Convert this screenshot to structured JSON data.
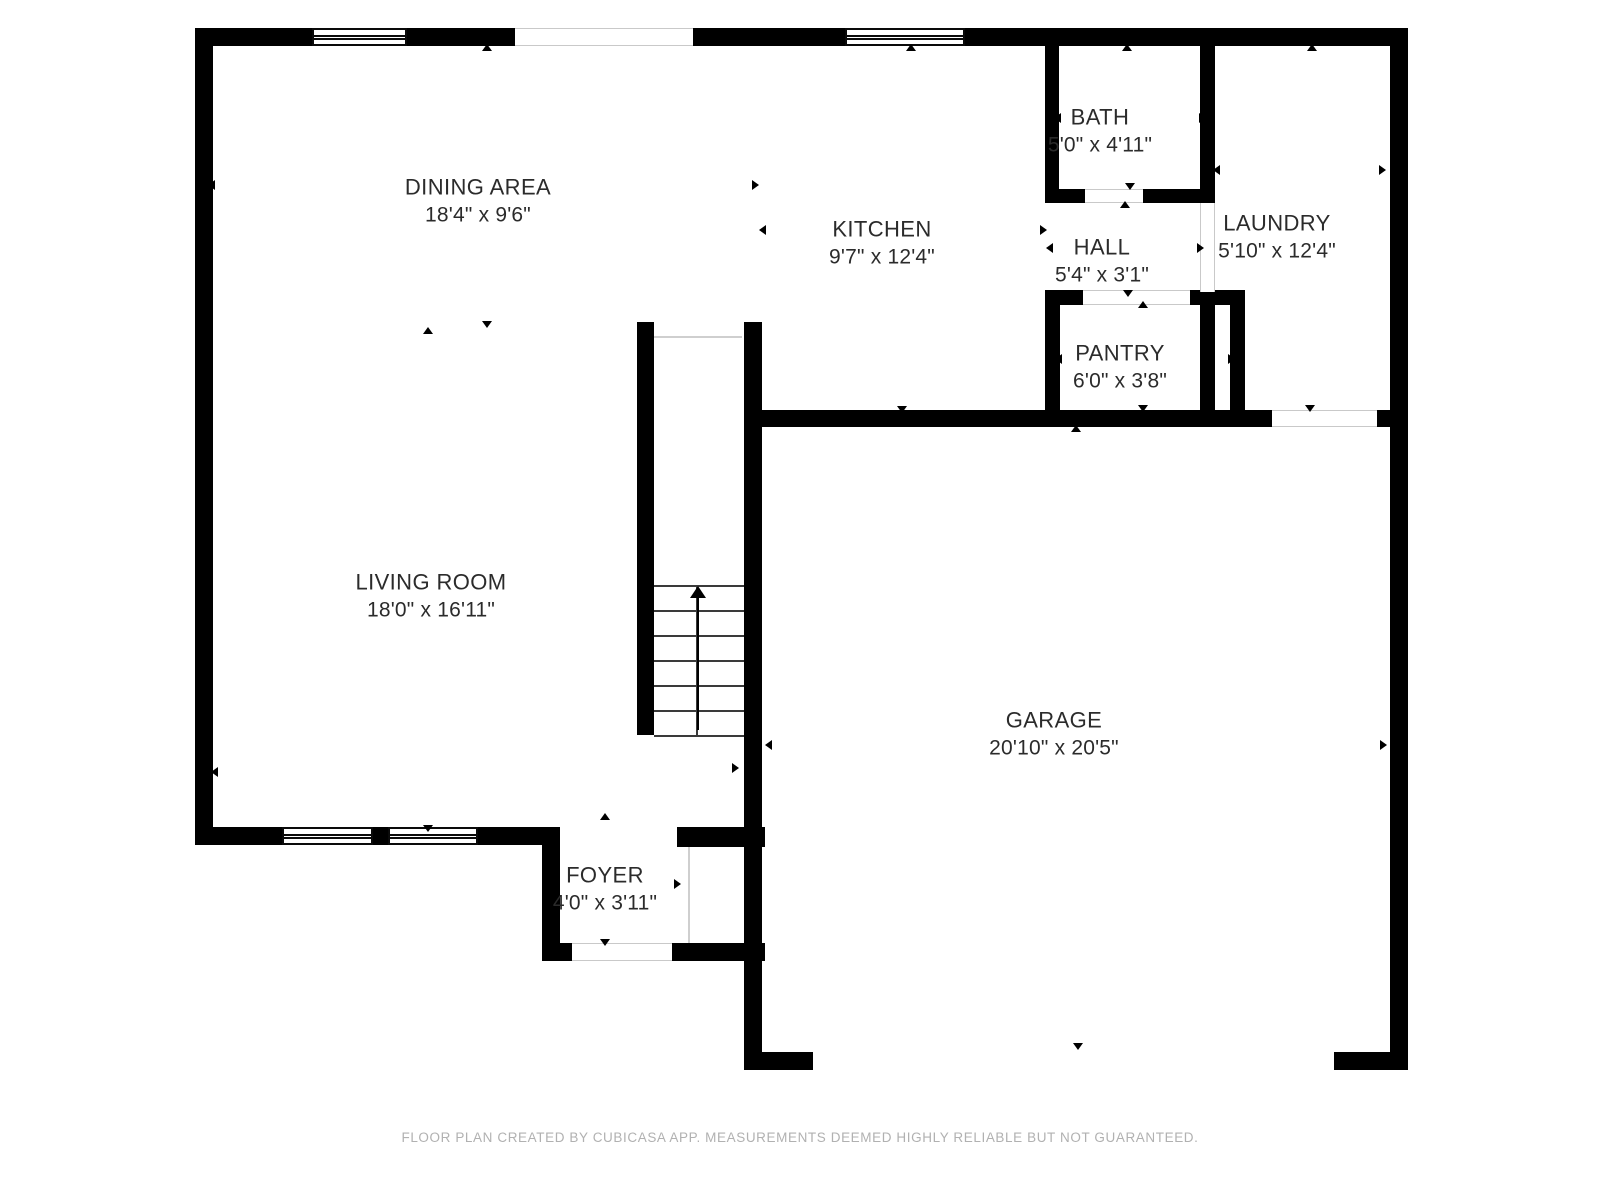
{
  "footer": {
    "text": "FLOOR PLAN CREATED BY CUBICASA APP. MEASUREMENTS DEEMED HIGHLY RELIABLE BUT NOT GUARANTEED.",
    "y": 1130
  },
  "colors": {
    "wall": "#000000",
    "background": "#ffffff",
    "label_text": "#2b2b2b",
    "footer_text": "#b1b1b1",
    "opening_line": "#c9c9c9"
  },
  "rooms": [
    {
      "id": "dining-area",
      "name": "DINING AREA",
      "dims": "18'4\" x 9'6\"",
      "cx": 478,
      "cy": 201
    },
    {
      "id": "kitchen",
      "name": "KITCHEN",
      "dims": "9'7\" x 12'4\"",
      "cx": 882,
      "cy": 243
    },
    {
      "id": "bath",
      "name": "BATH",
      "dims": "5'0\" x 4'11\"",
      "cx": 1100,
      "cy": 131
    },
    {
      "id": "hall",
      "name": "HALL",
      "dims": "5'4\" x 3'1\"",
      "cx": 1102,
      "cy": 261
    },
    {
      "id": "laundry",
      "name": "LAUNDRY",
      "dims": "5'10\" x 12'4\"",
      "cx": 1277,
      "cy": 237
    },
    {
      "id": "pantry",
      "name": "PANTRY",
      "dims": "6'0\" x 3'8\"",
      "cx": 1120,
      "cy": 367
    },
    {
      "id": "living-room",
      "name": "LIVING ROOM",
      "dims": "18'0\" x 16'11\"",
      "cx": 431,
      "cy": 596
    },
    {
      "id": "garage",
      "name": "GARAGE",
      "dims": "20'10\" x 20'5\"",
      "cx": 1054,
      "cy": 734
    },
    {
      "id": "foyer",
      "name": "FOYER",
      "dims": "4'0\" x 3'11\"",
      "cx": 605,
      "cy": 889
    }
  ],
  "walls": [
    {
      "x": 195,
      "y": 28,
      "w": 117,
      "h": 18
    },
    {
      "x": 407,
      "y": 28,
      "w": 108,
      "h": 18
    },
    {
      "x": 693,
      "y": 28,
      "w": 152,
      "h": 18
    },
    {
      "x": 965,
      "y": 28,
      "w": 443,
      "h": 18
    },
    {
      "x": 195,
      "y": 28,
      "w": 18,
      "h": 817
    },
    {
      "x": 195,
      "y": 827,
      "w": 87,
      "h": 18
    },
    {
      "x": 373,
      "y": 827,
      "w": 15,
      "h": 18
    },
    {
      "x": 478,
      "y": 827,
      "w": 82,
      "h": 18
    },
    {
      "x": 542,
      "y": 827,
      "w": 18,
      "h": 134
    },
    {
      "x": 542,
      "y": 943,
      "w": 30,
      "h": 18
    },
    {
      "x": 672,
      "y": 943,
      "w": 93,
      "h": 18
    },
    {
      "x": 677,
      "y": 827,
      "w": 88,
      "h": 20
    },
    {
      "x": 744,
      "y": 322,
      "w": 18,
      "h": 748
    },
    {
      "x": 762,
      "y": 1052,
      "w": 51,
      "h": 18
    },
    {
      "x": 637,
      "y": 322,
      "w": 17,
      "h": 413
    },
    {
      "x": 762,
      "y": 410,
      "w": 510,
      "h": 17
    },
    {
      "x": 1377,
      "y": 410,
      "w": 14,
      "h": 17
    },
    {
      "x": 1045,
      "y": 46,
      "w": 14,
      "h": 157
    },
    {
      "x": 1045,
      "y": 189,
      "w": 40,
      "h": 14
    },
    {
      "x": 1143,
      "y": 189,
      "w": 72,
      "h": 14
    },
    {
      "x": 1200,
      "y": 46,
      "w": 15,
      "h": 157
    },
    {
      "x": 1200,
      "y": 292,
      "w": 15,
      "h": 118
    },
    {
      "x": 1045,
      "y": 290,
      "w": 38,
      "h": 15
    },
    {
      "x": 1190,
      "y": 290,
      "w": 55,
      "h": 15
    },
    {
      "x": 1045,
      "y": 290,
      "w": 15,
      "h": 137
    },
    {
      "x": 1230,
      "y": 290,
      "w": 15,
      "h": 137
    },
    {
      "x": 1390,
      "y": 28,
      "w": 18,
      "h": 397
    },
    {
      "x": 1390,
      "y": 410,
      "w": 18,
      "h": 660
    },
    {
      "x": 1334,
      "y": 1052,
      "w": 74,
      "h": 18
    }
  ],
  "windows": [
    {
      "x": 312,
      "y": 28,
      "w": 95,
      "h": 18
    },
    {
      "x": 845,
      "y": 28,
      "w": 120,
      "h": 18
    },
    {
      "x": 282,
      "y": 827,
      "w": 91,
      "h": 18
    },
    {
      "x": 388,
      "y": 827,
      "w": 90,
      "h": 18
    }
  ],
  "openings": [
    {
      "x": 515,
      "y": 28,
      "w": 178,
      "h": 18,
      "o": "h"
    },
    {
      "x": 1272,
      "y": 410,
      "w": 105,
      "h": 17,
      "o": "h"
    },
    {
      "x": 572,
      "y": 943,
      "w": 100,
      "h": 18,
      "o": "h"
    },
    {
      "x": 1085,
      "y": 189,
      "w": 58,
      "h": 14,
      "o": "h"
    },
    {
      "x": 1083,
      "y": 290,
      "w": 107,
      "h": 15,
      "o": "h"
    },
    {
      "x": 1200,
      "y": 203,
      "w": 15,
      "h": 89,
      "o": "v"
    }
  ],
  "thin_lines": [
    {
      "x": 654,
      "y": 336,
      "w": 88,
      "h": 2
    },
    {
      "x": 688,
      "y": 847,
      "w": 2,
      "h": 96
    }
  ],
  "stairs": {
    "x": 654,
    "y": 585,
    "w": 90,
    "h": 150,
    "treads": 6,
    "rail_x": 696,
    "arrow_x": 697,
    "arrow_top": 588,
    "arrow_bottom": 730
  },
  "arrows": [
    {
      "x": 487,
      "y": 48,
      "d": "up"
    },
    {
      "x": 911,
      "y": 48,
      "d": "up"
    },
    {
      "x": 1127,
      "y": 48,
      "d": "up"
    },
    {
      "x": 1312,
      "y": 48,
      "d": "up"
    },
    {
      "x": 428,
      "y": 331,
      "d": "up"
    },
    {
      "x": 1125,
      "y": 205,
      "d": "up"
    },
    {
      "x": 1143,
      "y": 305,
      "d": "up"
    },
    {
      "x": 1076,
      "y": 429,
      "d": "up"
    },
    {
      "x": 605,
      "y": 817,
      "d": "up"
    },
    {
      "x": 487,
      "y": 324,
      "d": "down"
    },
    {
      "x": 902,
      "y": 409,
      "d": "down"
    },
    {
      "x": 1130,
      "y": 186,
      "d": "down"
    },
    {
      "x": 1128,
      "y": 293,
      "d": "down"
    },
    {
      "x": 1143,
      "y": 408,
      "d": "down"
    },
    {
      "x": 1310,
      "y": 408,
      "d": "down"
    },
    {
      "x": 428,
      "y": 828,
      "d": "down"
    },
    {
      "x": 605,
      "y": 942,
      "d": "down"
    },
    {
      "x": 1078,
      "y": 1046,
      "d": "down"
    },
    {
      "x": 212,
      "y": 185,
      "d": "left"
    },
    {
      "x": 763,
      "y": 230,
      "d": "left"
    },
    {
      "x": 1058,
      "y": 118,
      "d": "left"
    },
    {
      "x": 1050,
      "y": 248,
      "d": "left"
    },
    {
      "x": 1217,
      "y": 170,
      "d": "left"
    },
    {
      "x": 1059,
      "y": 359,
      "d": "left"
    },
    {
      "x": 215,
      "y": 772,
      "d": "left"
    },
    {
      "x": 769,
      "y": 745,
      "d": "left"
    },
    {
      "x": 557,
      "y": 884,
      "d": "left"
    },
    {
      "x": 755,
      "y": 185,
      "d": "right"
    },
    {
      "x": 1043,
      "y": 230,
      "d": "right"
    },
    {
      "x": 1202,
      "y": 118,
      "d": "right"
    },
    {
      "x": 1200,
      "y": 248,
      "d": "right"
    },
    {
      "x": 1382,
      "y": 170,
      "d": "right"
    },
    {
      "x": 1231,
      "y": 359,
      "d": "right"
    },
    {
      "x": 735,
      "y": 768,
      "d": "right"
    },
    {
      "x": 1383,
      "y": 745,
      "d": "right"
    },
    {
      "x": 677,
      "y": 884,
      "d": "right"
    }
  ]
}
